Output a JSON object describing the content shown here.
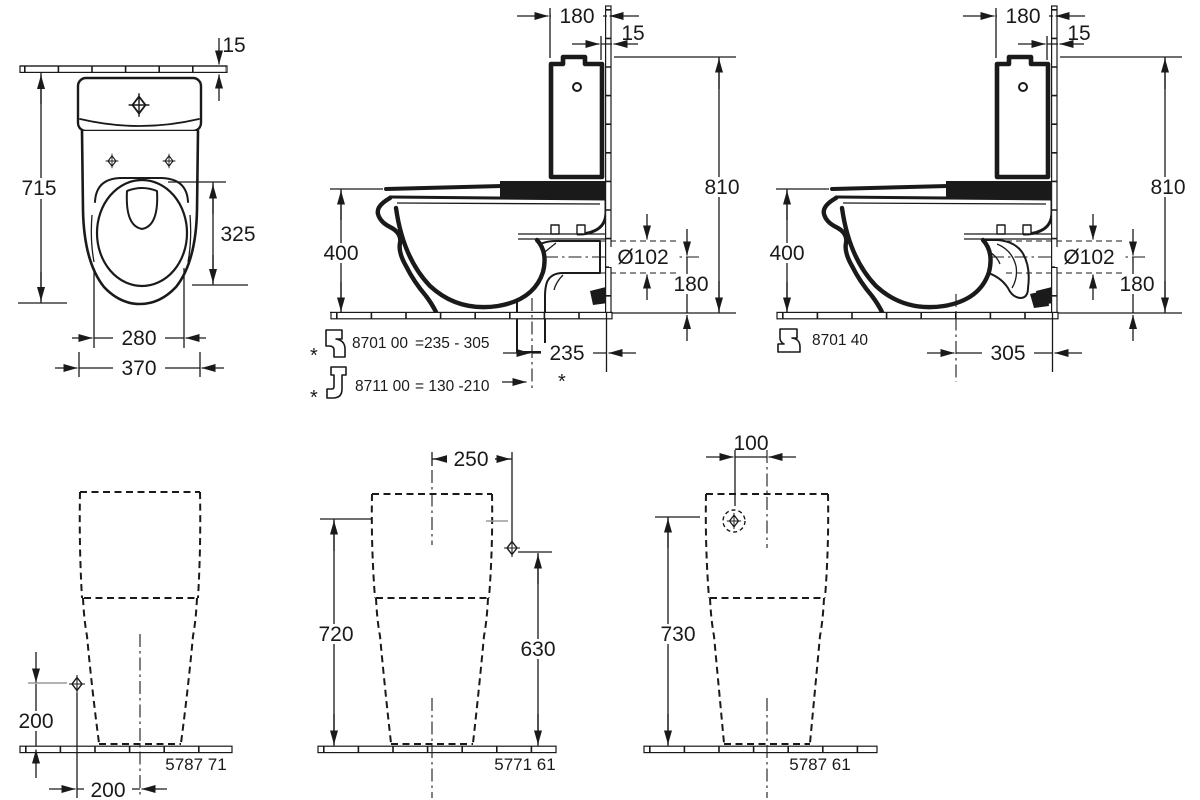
{
  "drawing": {
    "top_view": {
      "wall_thickness": "15",
      "depth_total": "715",
      "seat_opening_length": "325",
      "bowl_width": "280",
      "tank_width": "370"
    },
    "side_view_bottom_outlet": {
      "flush_to_wall": "180",
      "tank_wall_gap": "15",
      "height_total": "810",
      "rim_height": "400",
      "outlet_diameter": "Ø102",
      "outlet_center_height": "180",
      "outlet_to_wall": "235",
      "outlet_note_marker": "*",
      "accessories": [
        {
          "marker": "*",
          "code": "8701 00",
          "range": "=235 - 305"
        },
        {
          "marker": "*",
          "code": "8711 00",
          "range": "= 130 -210"
        }
      ]
    },
    "side_view_rear_outlet": {
      "flush_to_wall": "180",
      "tank_wall_gap": "15",
      "height_total": "810",
      "rim_height": "400",
      "outlet_diameter": "Ø102",
      "outlet_center_height": "180",
      "outlet_to_wall": "305",
      "accessory": {
        "code": "8701 40"
      }
    },
    "rear_view_left": {
      "supply_height": "200",
      "supply_offset": "200",
      "model": "5787 71"
    },
    "rear_view_center": {
      "supply_offset": "250",
      "tank_height": "720",
      "supply_height": "630",
      "model": "5771 61"
    },
    "rear_view_right": {
      "supply_offset": "100",
      "tank_height": "730",
      "model": "5787 61"
    }
  }
}
